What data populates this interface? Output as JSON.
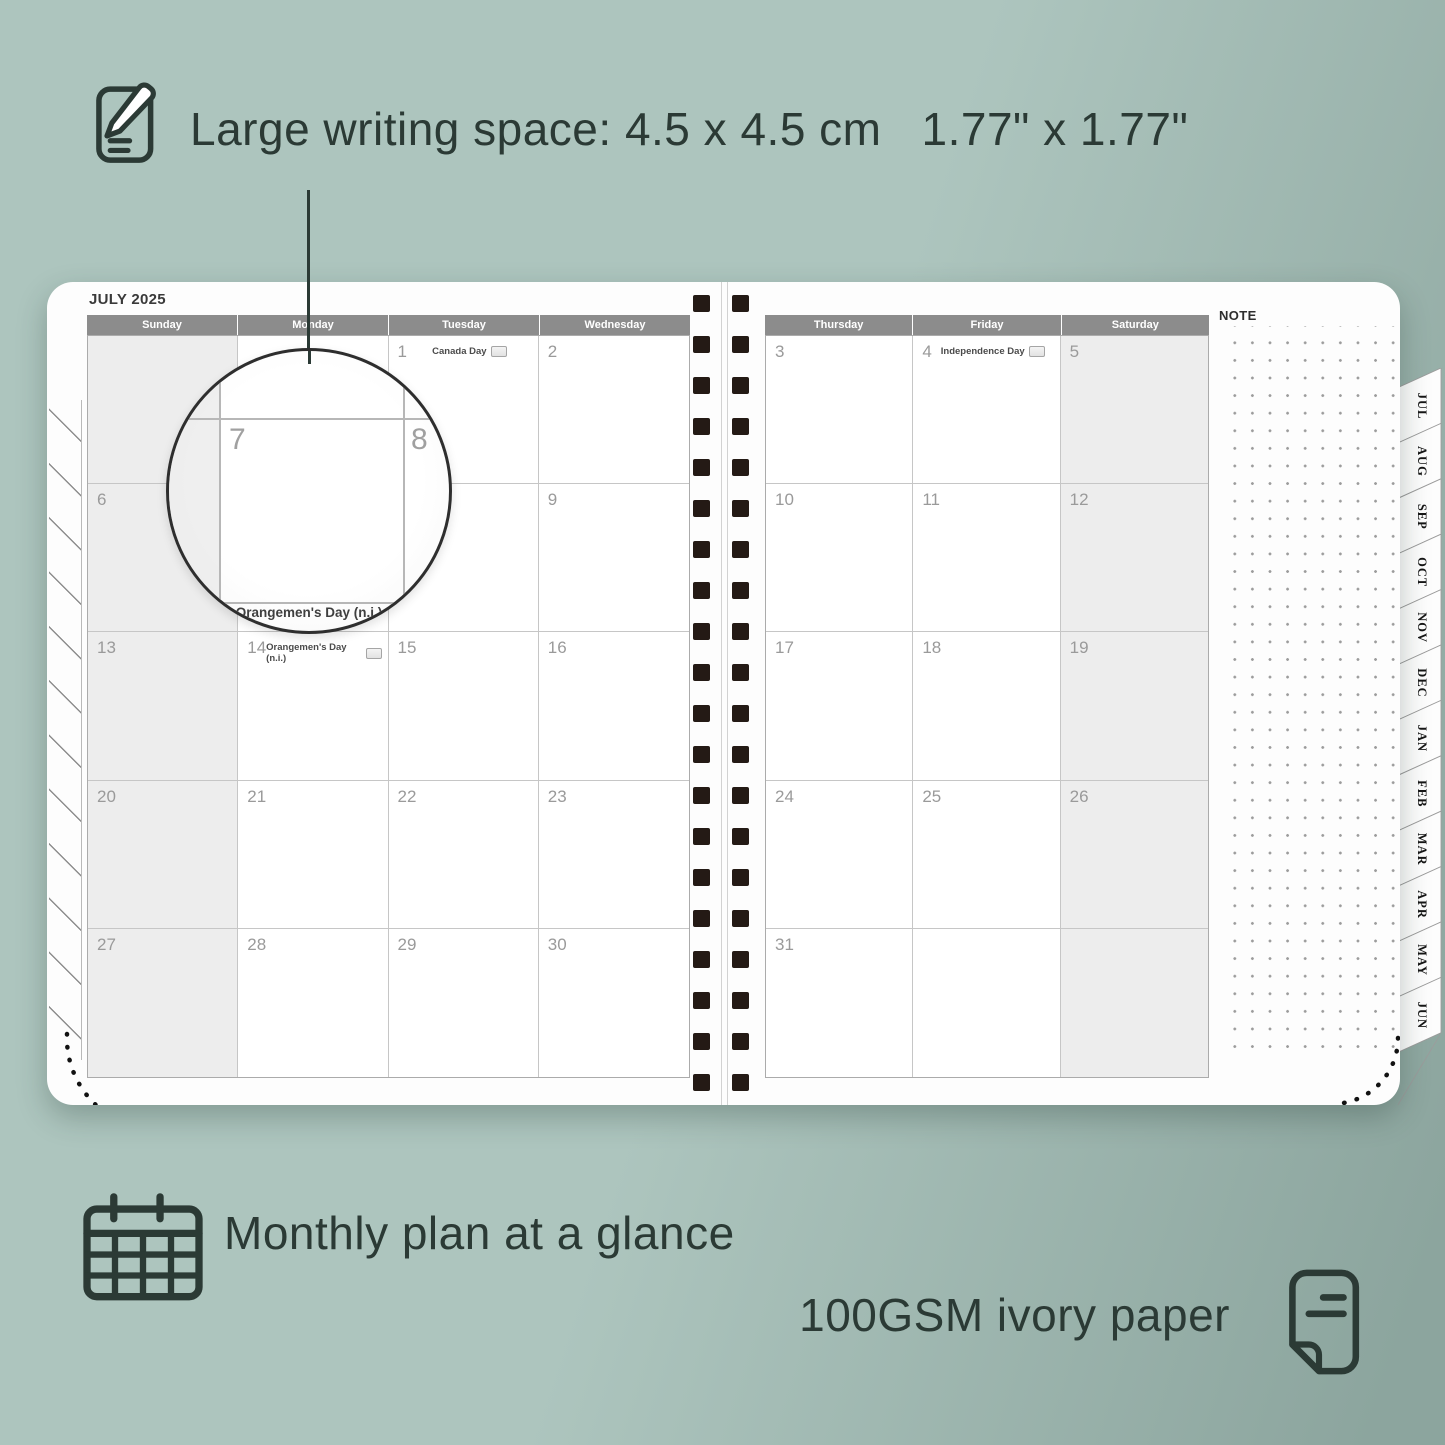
{
  "features": {
    "writing_space": {
      "text_main": "Large writing space: 4.5 x 4.5 cm",
      "text_inches": "1.77\" x 1.77\""
    },
    "monthly": "Monthly plan at a glance",
    "paper": "100GSM ivory paper"
  },
  "planner": {
    "month_title": "JULY 2025",
    "note_label": "NOTE",
    "left_day_headers": [
      "Sunday",
      "Monday",
      "Tuesday",
      "Wednesday"
    ],
    "right_day_headers": [
      "Thursday",
      "Friday",
      "Saturday"
    ],
    "left_rows": [
      [
        {
          "n": ""
        },
        {
          "n": ""
        },
        {
          "n": "1",
          "holiday": "Canada Day",
          "flag": true
        },
        {
          "n": "2"
        }
      ],
      [
        {
          "n": "6"
        },
        {
          "n": "7"
        },
        {
          "n": "8"
        },
        {
          "n": "9"
        }
      ],
      [
        {
          "n": "13"
        },
        {
          "n": "14",
          "holiday": "Orangemen's Day (n.i.)",
          "flag": true
        },
        {
          "n": "15"
        },
        {
          "n": "16"
        }
      ],
      [
        {
          "n": "20"
        },
        {
          "n": "21"
        },
        {
          "n": "22"
        },
        {
          "n": "23"
        }
      ],
      [
        {
          "n": "27"
        },
        {
          "n": "28"
        },
        {
          "n": "29"
        },
        {
          "n": "30"
        }
      ]
    ],
    "right_rows": [
      [
        {
          "n": "3"
        },
        {
          "n": "4",
          "holiday": "Independence Day",
          "flag": true
        },
        {
          "n": "5"
        }
      ],
      [
        {
          "n": "10"
        },
        {
          "n": "11"
        },
        {
          "n": "12"
        }
      ],
      [
        {
          "n": "17"
        },
        {
          "n": "18"
        },
        {
          "n": "19"
        }
      ],
      [
        {
          "n": "24"
        },
        {
          "n": "25"
        },
        {
          "n": "26"
        }
      ],
      [
        {
          "n": "31"
        },
        {
          "n": ""
        },
        {
          "n": ""
        }
      ]
    ],
    "weekend_col_left": 0,
    "weekend_col_right": 2,
    "month_tabs": [
      "JUL",
      "AUG",
      "SEP",
      "OCT",
      "NOV",
      "DEC",
      "JAN",
      "FEB",
      "MAR",
      "APR",
      "MAY",
      "JUN"
    ],
    "spiral_rings_per_column": 20
  },
  "magnifier": {
    "left_day": "7",
    "right_day": "8",
    "caption": "Orangemen's Day (n.i.)"
  },
  "icons": [
    "note-pencil-icon",
    "calendar-grid-icon",
    "page-fold-icon",
    "flag-icon"
  ],
  "colors": {
    "bg1": "#adc5be",
    "bg2": "#8ca59e",
    "ink": "#2b3a35",
    "page": "#fdfdfd",
    "headerbar": "#8c8c8c",
    "weekend": "#ededed",
    "gridline": "#c6c6c6",
    "gridborder": "#ababab",
    "datenum": "#9a9a9a",
    "spiral": "#241a15"
  }
}
